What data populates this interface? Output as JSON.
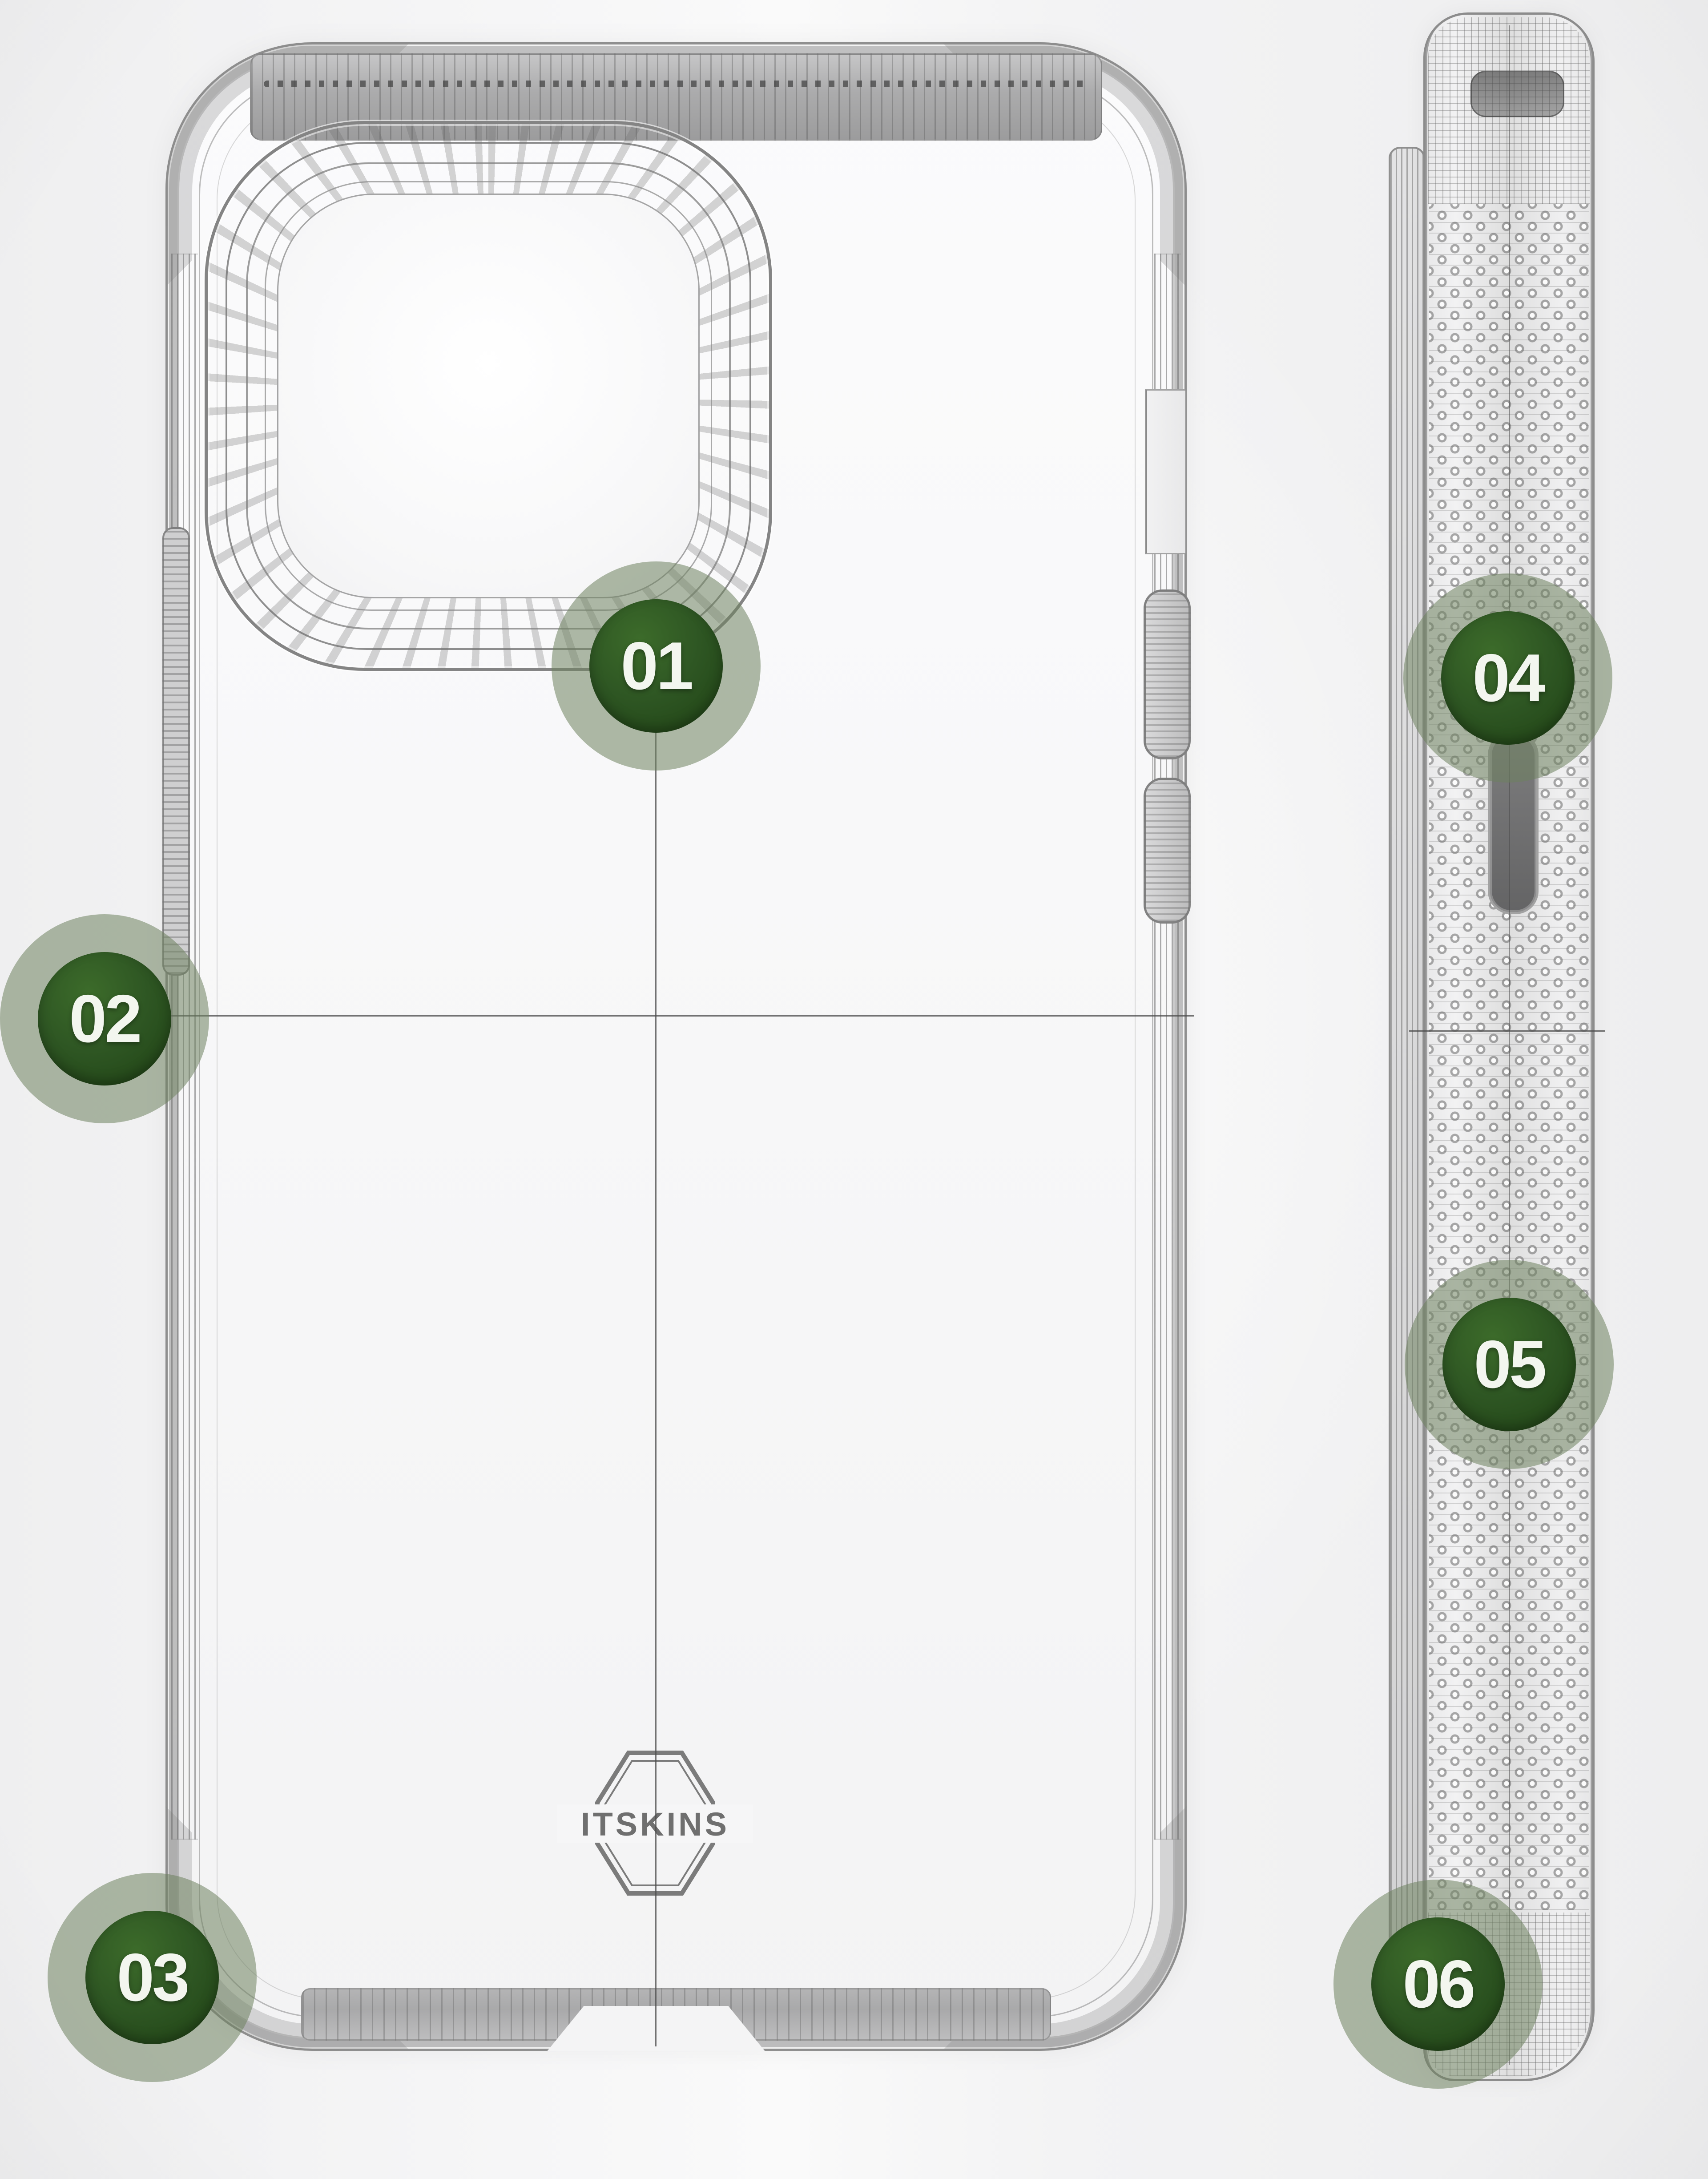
{
  "diagram": {
    "brand": "ITSKINS",
    "callouts": [
      {
        "id": "badge-01",
        "label": "01"
      },
      {
        "id": "badge-02",
        "label": "02"
      },
      {
        "id": "badge-03",
        "label": "03"
      },
      {
        "id": "badge-04",
        "label": "04"
      },
      {
        "id": "badge-05",
        "label": "05"
      },
      {
        "id": "badge-06",
        "label": "06"
      }
    ],
    "colors": {
      "badge_core": "#2e5623",
      "badge_core_dark": "#1f4214",
      "badge_ring": "rgba(110,130,95,0.55)",
      "digit": "#f3f6ef",
      "wireframe": "#8f8f8f",
      "callout_line": "#4d4d4d",
      "background": "#f4f4f5"
    }
  }
}
